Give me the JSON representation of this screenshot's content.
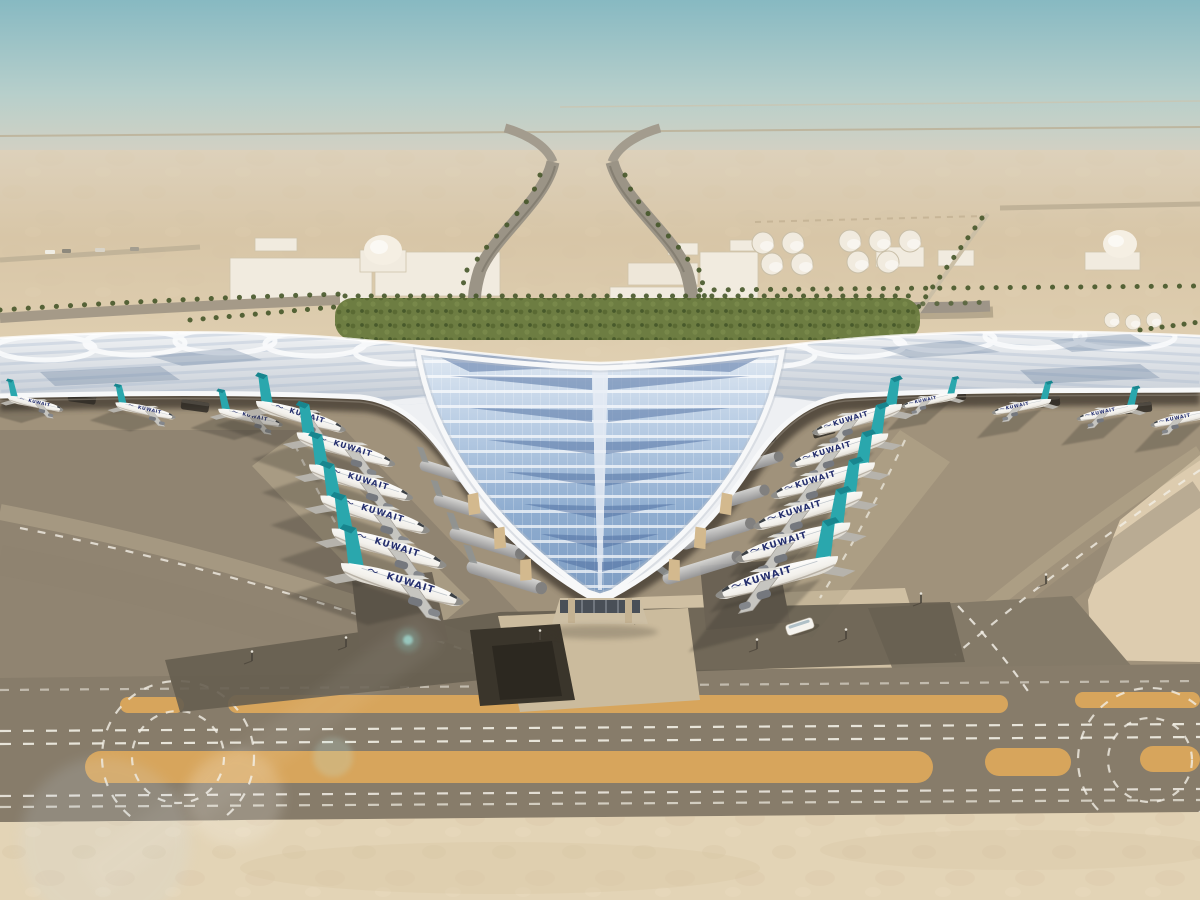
{
  "title": "Kuwait International Airport new terminal — aerial architectural rendering",
  "scene": {
    "airline_title": "KUWAIT",
    "aircraft": {
      "left_contact_stands": 6,
      "right_contact_stands": 6,
      "left_pier_stands": 3,
      "right_pier_stands": 4,
      "shadowed_stands": 8
    },
    "colors": {
      "sky_top": "#87b9c2",
      "sky_mid": "#b7cfcb",
      "horizon_haze": "#dcd1c0",
      "desert": "#d8c6a7",
      "desert_light": "#e0d0b2",
      "sand": "#e3d4b6",
      "sand_mottle": "#cdb896",
      "tarmac": "#a0927b",
      "tarmac_dark": "#8d8170",
      "taxiway": "#877c6a",
      "concrete_light": "#d5c5a7",
      "service_road": "#665e50",
      "tunnel": "#2c2820",
      "orange_marking": "#d7a55c",
      "marking_white": "#f2efe6",
      "roof_white": "#eef0f3",
      "roof_shade": "#c6cdd6",
      "glass_light": "#dfe8f2",
      "glass_mid": "#8fadd0",
      "glass_deep": "#4a6b9e",
      "fascia": "#f7f8f9",
      "canopy_shadow": "#3f382f",
      "hedge_green": "#6d7d42",
      "palm_green": "#46572a",
      "tail_teal": "#2aa7ad",
      "tail_teal_deep": "#18858e",
      "fuselage_white": "#f3f1ec",
      "titles_navy": "#252f6e",
      "building_white": "#f1ebdf",
      "vehicle_dark": "#2f2b25"
    }
  }
}
